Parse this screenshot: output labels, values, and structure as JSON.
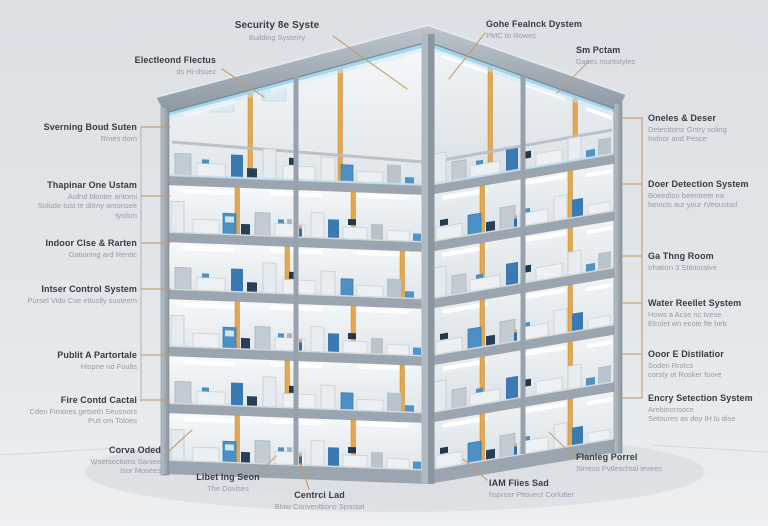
{
  "figure": {
    "kind": "building-cutaway-systems-diagram",
    "storeys_visible": 6
  },
  "palette": {
    "background": "#e2e5e9",
    "label_title": "#373c42",
    "label_subtitle": "#969da6",
    "leader_line": "#c49a6b",
    "structure_grey": "#9aa4ae",
    "glow_blue": "#a8d9f0",
    "column_orange": "#e3a74e",
    "machine_blue": "#4b8fc3"
  },
  "labels": {
    "top": [
      {
        "title": "Security 8e Syste",
        "sub": "Building Systerry"
      },
      {
        "title": "Electleond Flectus",
        "sub": "ds Hi-dsuez"
      },
      {
        "title": "Gohe Fealnck Dystem",
        "sub": "PMC to Rowes"
      },
      {
        "title": "Sm Pctam",
        "sub": "Dases muntstyles"
      }
    ],
    "left": [
      {
        "title": "Sverning Boud Suten",
        "sub": "Rmes dom"
      },
      {
        "title": "Thapinar One Ustam",
        "sub": "Aufnd blonter antomi\nSolude tust te ditrny amonsee\ntyolsm"
      },
      {
        "title": "Indoor Clse & Rarten",
        "sub": "Gationing ard Rentic"
      },
      {
        "title": "Intser Control System",
        "sub": "Pursel Vido Cse ettuslly susteem"
      },
      {
        "title": "Publit A Partortale",
        "sub": "Hispne nd Foults"
      },
      {
        "title": "Fire Contd Cactal",
        "sub": "Cden Fimores getseth Seusnors\nPuti om Toloes"
      }
    ],
    "right": [
      {
        "title": "Oneles & Deser",
        "sub": "Detecttorsr Gntry soling\nIndnor and Pesce"
      },
      {
        "title": "Doer Detection System",
        "sub": "Boeedion beentrete na\nfanocis aur your rVeoustad"
      },
      {
        "title": "Ga Thng Room",
        "sub": "Irhation 3 Stitrioralve"
      },
      {
        "title": "Water Reellet System",
        "sub": "Hows a Acse nc tvese\nEtrolet wn ecote fte heb"
      },
      {
        "title": "Ooor E Distilatior",
        "sub": "Soden Rrolcs\ncorsty ot Rosker foore"
      },
      {
        "title": "Encry Setection System",
        "sub": "Arebinorisoce\nSetoures as doy IH lu dise"
      }
    ],
    "bottom": [
      {
        "title": "Corva Oded",
        "sub": "Wsersoctions Saniee\nIsor Mosees"
      },
      {
        "title": "Libet Ing Seon",
        "sub": "The Dovises"
      },
      {
        "title": "Centrci Lad",
        "sub": "Blow Conventtions Spastat"
      },
      {
        "title": "IAM Flies Sad",
        "sub": "hsprosr Pttovect Corlutter"
      },
      {
        "title": "Flanleg Porrel",
        "sub": "Sirreso Pvtleschtal ievees"
      }
    ]
  }
}
